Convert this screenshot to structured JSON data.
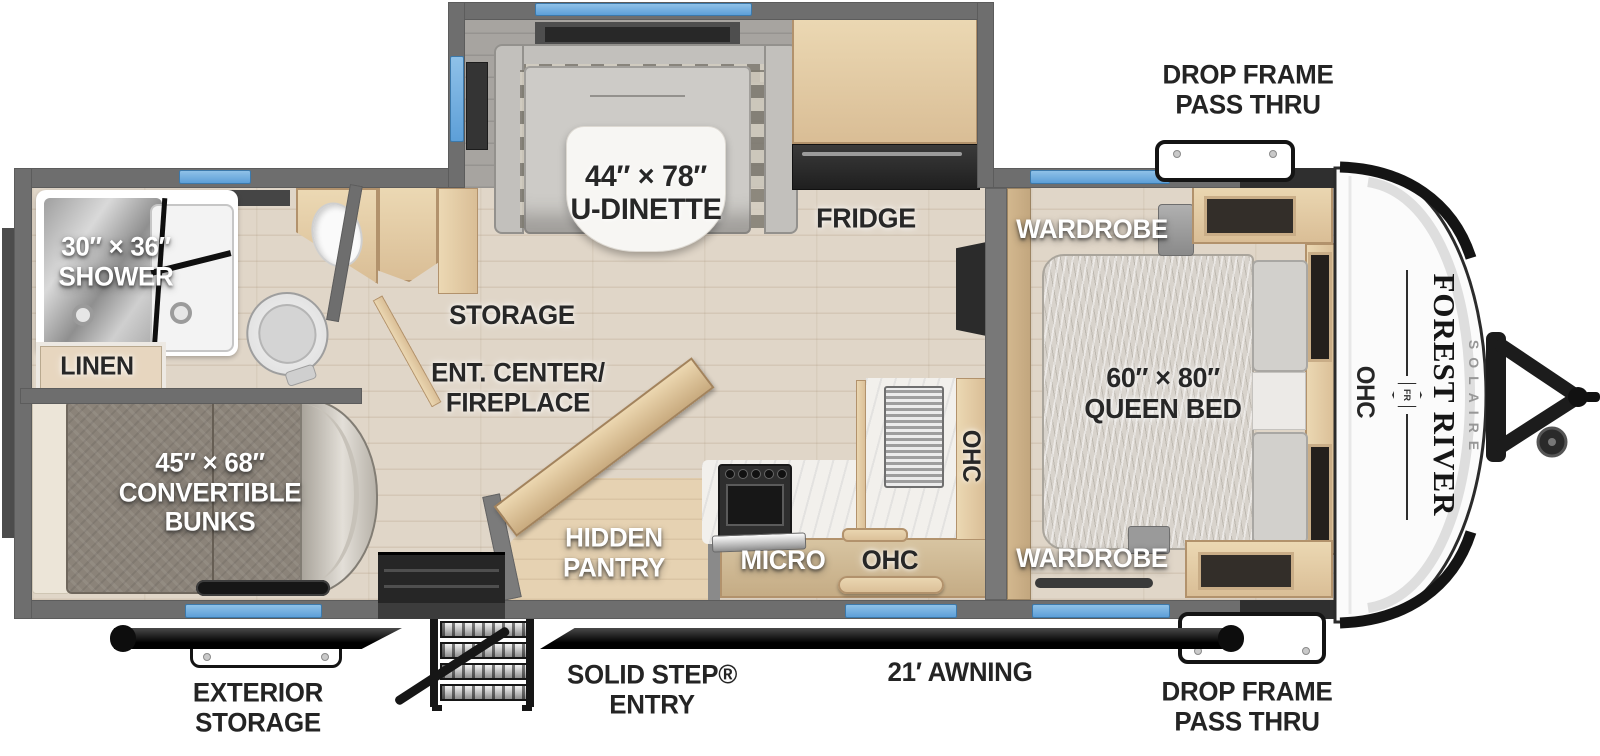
{
  "title": "Forest River Solaire Travel Trailer Floorplan",
  "colors": {
    "wall": "#6e6e6e",
    "wall_dark": "#4c4c4c",
    "floor": "#e0d6c8",
    "slide_floor": "#a7a4a0",
    "window": "#5d9fd8",
    "wood": "#d9bd95",
    "wood_light": "#ecd9b4",
    "wood_dark": "#b2926c",
    "counter": "#f2f0ec",
    "cushion": "#c2c0bc",
    "bunk": "#8b8379",
    "mattress": "#d8d3cc",
    "black": "#141414",
    "label_dark": "#272727",
    "label_white": "#ffffff",
    "cap": "#fbfbfb"
  },
  "branding": {
    "make": "FOREST RIVER",
    "model": "SOLAIRE",
    "badge": "FR"
  },
  "callouts": {
    "drop_frame_top": {
      "line1": "DROP FRAME",
      "line2": "PASS THRU"
    },
    "drop_frame_bottom": {
      "line1": "DROP FRAME",
      "line2": "PASS THRU"
    },
    "exterior_storage": {
      "line1": "EXTERIOR",
      "line2": "STORAGE"
    },
    "solid_step": {
      "line1": "SOLID STEP®",
      "line2": "ENTRY"
    },
    "awning": {
      "line1": "21′ AWNING"
    }
  },
  "rooms": {
    "u_dinette": {
      "line1": "44″ × 78″",
      "line2": "U-DINETTE"
    },
    "fridge": {
      "line1": "FRIDGE"
    },
    "shower": {
      "line1": "30″ × 36″",
      "line2": "SHOWER"
    },
    "linen": {
      "line1": "LINEN"
    },
    "storage": {
      "line1": "STORAGE"
    },
    "ent_center": {
      "line1": "ENT. CENTER/",
      "line2": "FIREPLACE"
    },
    "hidden_pantry": {
      "line1": "HIDDEN",
      "line2": "PANTRY"
    },
    "micro": {
      "line1": "MICRO"
    },
    "ohc_kitchen": {
      "line1": "OHC"
    },
    "ohc_kitchen_upper": {
      "line1": "OHC"
    },
    "wardrobe_top": {
      "line1": "WARDROBE"
    },
    "wardrobe_bottom": {
      "line1": "WARDROBE"
    },
    "queen_bed": {
      "line1": "60″ × 80″",
      "line2": "QUEEN BED"
    },
    "ohc_front": {
      "line1": "OHC"
    },
    "bunks": {
      "line1": "45″ × 68″",
      "line2": "CONVERTIBLE",
      "line3": "BUNKS"
    }
  }
}
